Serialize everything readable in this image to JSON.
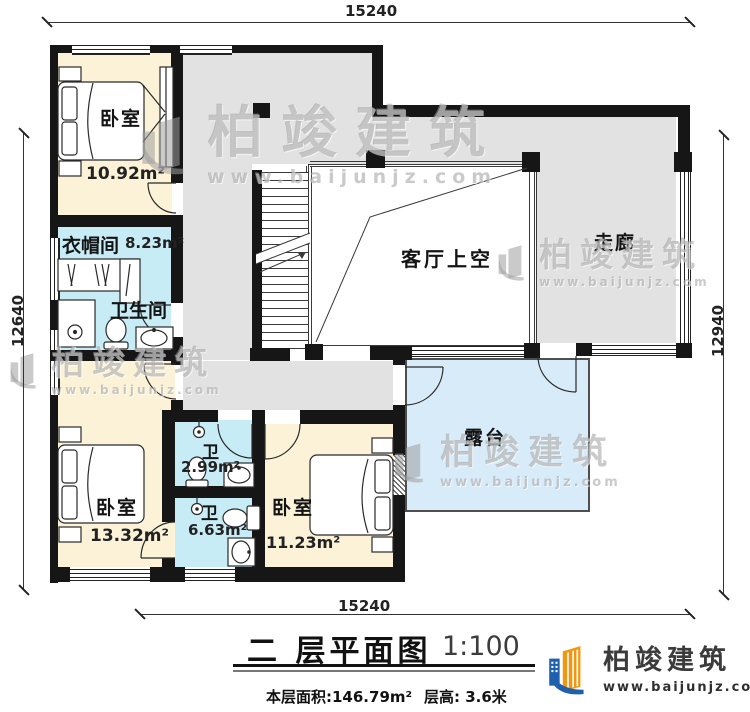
{
  "dimensions": {
    "top": "15240",
    "bottom": "15240",
    "left": "12640",
    "right": "12940"
  },
  "rooms": {
    "bedroom_tl": {
      "name": "卧室",
      "area": "10.92m²"
    },
    "cloakroom": {
      "name": "衣帽间",
      "area": "8.23m²"
    },
    "bathroom": {
      "name": "卫生间"
    },
    "living_void": {
      "name": "客厅上空"
    },
    "corridor": {
      "name": "走廊"
    },
    "bedroom_bl": {
      "name": "卧室",
      "area": "13.32m²"
    },
    "wc_small": {
      "name": "卫",
      "area": "2.99m²"
    },
    "wc_ensuite": {
      "name": "卫",
      "area": "6.63m²"
    },
    "bedroom_br": {
      "name": "卧室",
      "area": "11.23m²"
    },
    "terrace": {
      "name": "露台"
    }
  },
  "title": {
    "main": "二 层平面图",
    "scale": "1:100",
    "floor_area": "本层面积:146.79m²",
    "floor_height": "层高: 3.6米"
  },
  "brand": {
    "name": "柏竣建筑",
    "url": "www.baijunjz.com"
  },
  "watermark": {
    "name": "柏竣建筑",
    "url": "www.baijunjz.com"
  },
  "colors": {
    "bedroom_fill": "#fbf2d8",
    "bath_fill": "#c7ecf5",
    "hall_fill": "#e3e2e2",
    "terrace_fill": "#d8ebf8",
    "wall": "#161616",
    "brand_blue": "#1e5fae",
    "brand_orange": "#f2960f"
  }
}
